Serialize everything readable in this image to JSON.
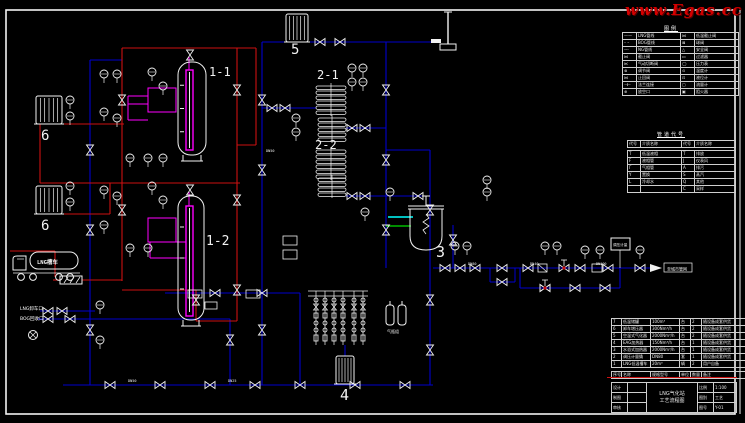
{
  "watermark": {
    "text": "www.Egas.cc"
  },
  "colors": {
    "background": "#000000",
    "line_white": "#f2f2f2",
    "pipe_gas_blue": "#0000cd",
    "pipe_liquid_red": "#cc1111",
    "instrument_magenta": "#ff00ff",
    "highlight_cyan": "#00ffff",
    "highlight_green": "#00bb00",
    "watermark_red": "#d40000"
  },
  "equipment_labels": {
    "tank1": "1-1",
    "tank2": "1-2",
    "vaporizer1": "2-1",
    "vaporizer2": "2-2",
    "heater": "3",
    "vaporizer4": "4",
    "eag_heater": "5",
    "pressurizer_a": "6",
    "pressurizer_b": "6"
  },
  "truck": {
    "body_text": "LNG槽车"
  },
  "ports": {
    "unload": "LNG卸车口",
    "bog": "BOG回收口",
    "outlet": "至城市管网"
  },
  "cylinders_label": "气瓶组",
  "skid_box_label": "调压计量",
  "pipe_tags": {
    "t1": "DN50",
    "t2": "DN25",
    "t3": "DN80",
    "t4": "DN40",
    "t5": "DN100",
    "t6": "DN50"
  },
  "legend": {
    "title": "图例",
    "rows": [
      {
        "ls": "——",
        "ln": "LNG管线",
        "rs": "⋈",
        "rn": "低温截止阀"
      },
      {
        "ls": "– –",
        "ln": "BOG管线",
        "rs": "⊠",
        "rn": "球阀"
      },
      {
        "ls": "┄┄",
        "ln": "NG管线",
        "rs": "△",
        "rn": "安全阀"
      },
      {
        "ls": "⋈",
        "ln": "截止阀",
        "rs": "▭",
        "rn": "过滤器"
      },
      {
        "ls": "⋉",
        "ln": "气动切断阀",
        "rs": "◯",
        "rn": "压力表"
      },
      {
        "ls": "⊗",
        "ln": "调节阀",
        "rs": "⊙",
        "rn": "温度计"
      },
      {
        "ls": "⋈",
        "ln": "止回阀",
        "rs": "⊡",
        "rn": "液位计"
      },
      {
        "ls": "⊣⊢",
        "ln": "法兰连接",
        "rs": "▢",
        "rn": "流量计"
      },
      {
        "ls": "⊕",
        "ln": "放空口",
        "rs": "▣",
        "rn": "阻火器"
      }
    ]
  },
  "codes": {
    "title": "管道代号",
    "headers": {
      "h1": "代号",
      "h2": "介质名称",
      "h3": "代号",
      "h4": "介质名称"
    },
    "rows": [
      {
        "a": "T",
        "an": "低温液相",
        "b": "T",
        "bn": "排放"
      },
      {
        "a": "F",
        "an": "液相管",
        "b": "J",
        "bn": "仪表风"
      },
      {
        "a": "Γ",
        "an": "气相管",
        "b": "A",
        "bn": "排污"
      },
      {
        "a": "Y",
        "an": "置换",
        "b": "S",
        "bn": "蒸汽"
      },
      {
        "a": "L",
        "an": "冷却水",
        "b": "Q",
        "bn": "其他"
      },
      {
        "a": "",
        "an": "",
        "b": "C",
        "bn": "采样"
      }
    ]
  },
  "bom": {
    "headers": {
      "h1": "序号",
      "h2": "名称",
      "h3": "规格型号",
      "h4": "单位",
      "h5": "数量",
      "h6": "备注"
    },
    "rows": [
      {
        "n": "7",
        "name": "低温储罐",
        "spec": "100m³",
        "unit": "台",
        "qty": "2",
        "rem": "随设备成套供货"
      },
      {
        "n": "6",
        "name": "卸车增压器",
        "spec": "300Nm³/h",
        "unit": "台",
        "qty": "2",
        "rem": "随设备成套供货"
      },
      {
        "n": "5",
        "name": "空温式气化器",
        "spec": "2000Nm³/h",
        "unit": "台",
        "qty": "2",
        "rem": "随设备成套供货"
      },
      {
        "n": "4",
        "name": "EAG加热器",
        "spec": "150Nm³/h",
        "unit": "台",
        "qty": "1",
        "rem": "随设备成套供货"
      },
      {
        "n": "3",
        "name": "水浴式加热器",
        "spec": "2000Nm³/h",
        "unit": "台",
        "qty": "1",
        "rem": "随设备成套供货"
      },
      {
        "n": "2",
        "name": "调压计量撬",
        "spec": "DN80",
        "unit": "套",
        "qty": "1",
        "rem": "随设备成套供货"
      },
      {
        "n": "1",
        "name": "LNG低温槽车",
        "spec": "20m³",
        "unit": "辆",
        "qty": "2",
        "rem": "用户自备"
      }
    ]
  },
  "titleblock": {
    "design_label": "设计",
    "draft_label": "制图",
    "check_label": "审核",
    "project": "LNG气化站",
    "drawing": "工艺流程图",
    "scale_label": "比例",
    "scale": "1:100",
    "type_label": "图别",
    "type": "工艺",
    "no_label": "图号",
    "no": "Y-01"
  }
}
